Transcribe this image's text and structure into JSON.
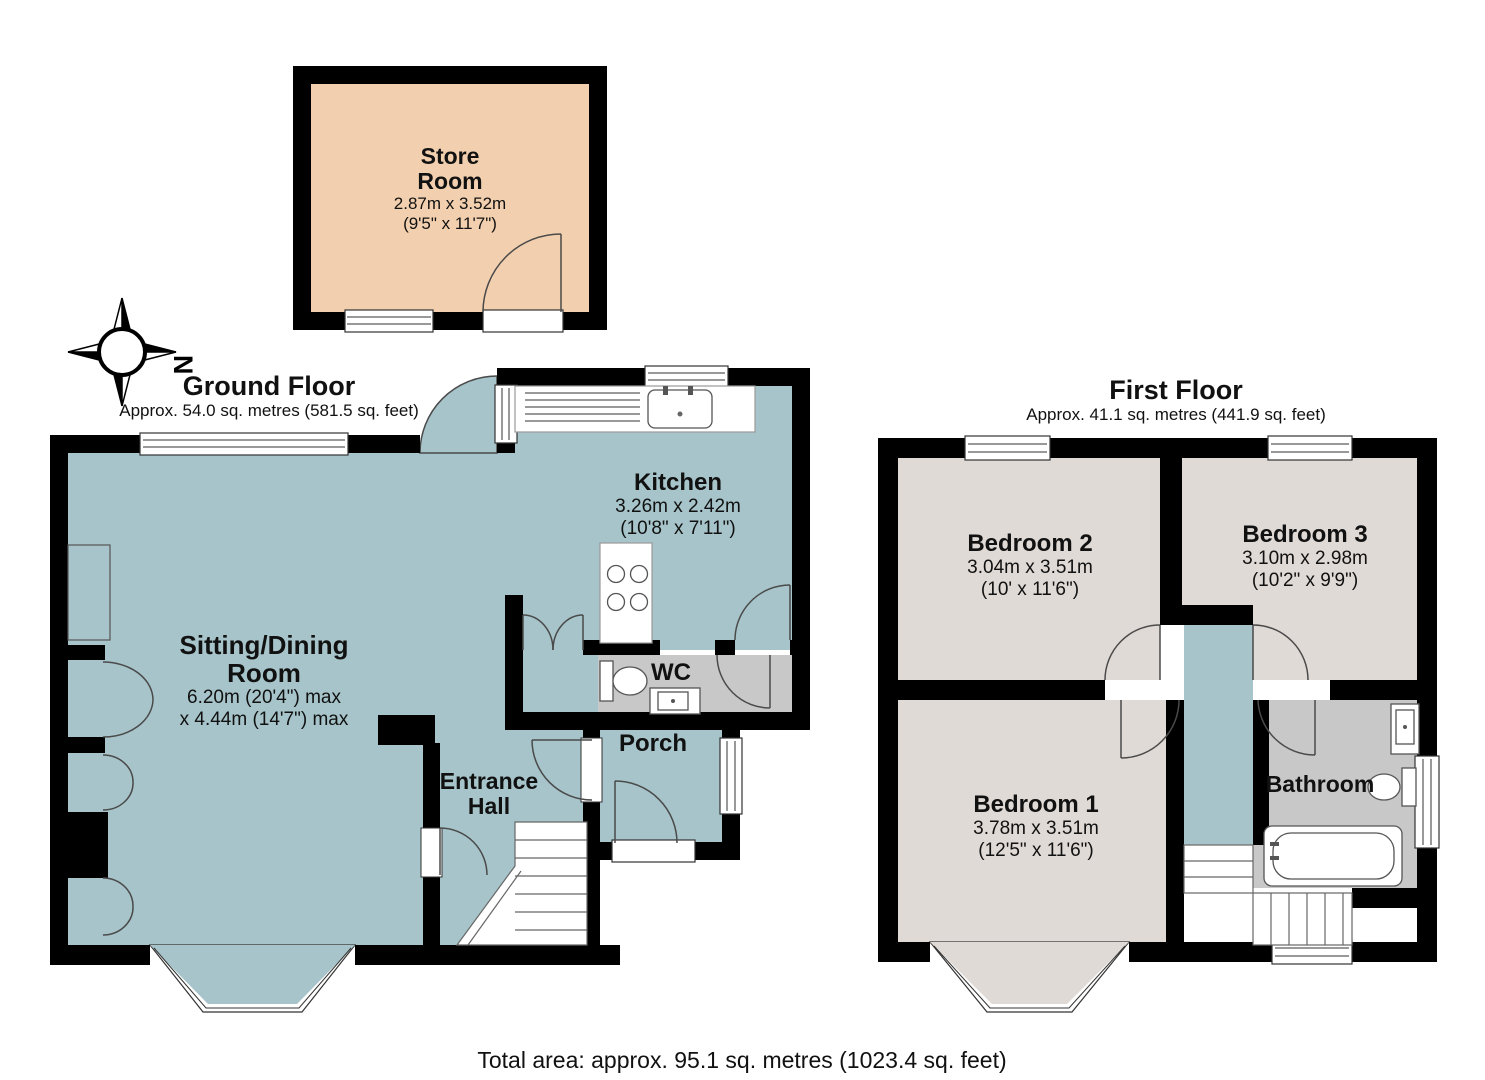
{
  "compass": {
    "label": "N"
  },
  "store_room": {
    "name_line1": "Store",
    "name_line2": "Room",
    "dims_metric": "2.87m x 3.52m",
    "dims_imperial": "(9'5\" x 11'7\")"
  },
  "ground_floor": {
    "title": "Ground Floor",
    "area": "Approx. 54.0 sq. metres (581.5 sq. feet)",
    "rooms": {
      "sitting_dining": {
        "name_line1": "Sitting/Dining",
        "name_line2": "Room",
        "dims_line1": "6.20m (20'4\") max",
        "dims_line2": "x 4.44m (14'7\") max"
      },
      "kitchen": {
        "name": "Kitchen",
        "dims_metric": "3.26m x 2.42m",
        "dims_imperial": "(10'8\" x 7'11\")"
      },
      "wc": {
        "name": "WC"
      },
      "porch": {
        "name": "Porch"
      },
      "entrance_hall": {
        "name_line1": "Entrance",
        "name_line2": "Hall"
      }
    }
  },
  "first_floor": {
    "title": "First Floor",
    "area": "Approx. 41.1 sq. metres (441.9 sq. feet)",
    "rooms": {
      "bedroom1": {
        "name": "Bedroom 1",
        "dims_metric": "3.78m x 3.51m",
        "dims_imperial": "(12'5\" x 11'6\")"
      },
      "bedroom2": {
        "name": "Bedroom 2",
        "dims_metric": "3.04m x 3.51m",
        "dims_imperial": "(10' x 11'6\")"
      },
      "bedroom3": {
        "name": "Bedroom 3",
        "dims_metric": "3.10m x 2.98m",
        "dims_imperial": "(10'2\" x 9'9\")"
      },
      "bathroom": {
        "name": "Bathroom"
      }
    }
  },
  "footer": {
    "total_area": "Total area: approx. 95.1 sq. metres (1023.4 sq. feet)"
  },
  "colors": {
    "teal": "#a6c4c9",
    "tan": "#f2cfae",
    "beige": "#e0dad6",
    "gray": "#c8c8c8",
    "wall": "#000000"
  }
}
